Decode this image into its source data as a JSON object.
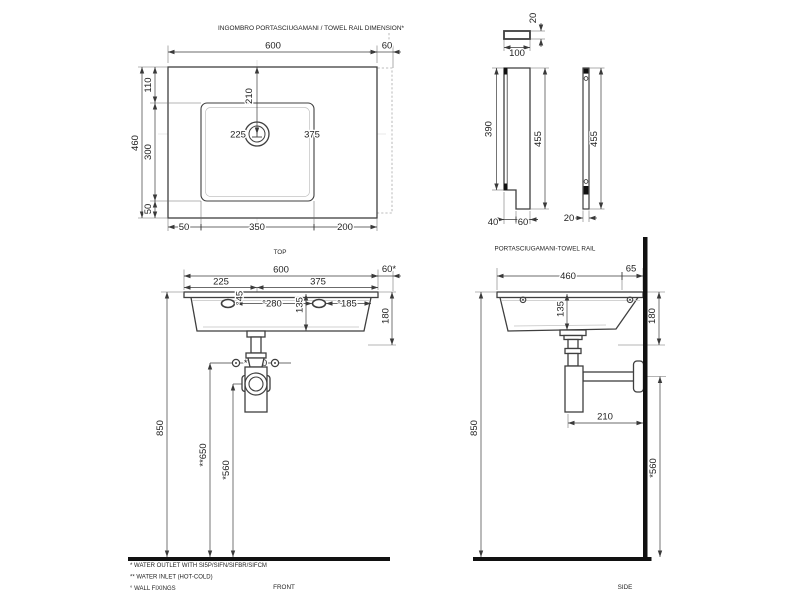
{
  "drawing": {
    "title": "INGOMBRO PORTASCIUGAMANI / TOWEL RAIL DIMENSION*",
    "views": {
      "top_label": "TOP",
      "front_label": "FRONT",
      "side_label": "SIDE",
      "rail_label": "PORTASCIUGAMANI-TOWEL RAIL"
    },
    "footnotes": {
      "outlet": "*  WATER OUTLET WITH SI5P/SIFN/SIFBR/SIFCM",
      "inlet": "** WATER INLET  (HOT-COLD)",
      "fixings": "° WALL FIXINGS"
    },
    "top": {
      "width": "600",
      "rail_overhang": "60",
      "edge_top": "110",
      "height": "460",
      "bowl_h": "300",
      "edge_bottom": "50",
      "drain_from_top": "210",
      "drain_left": "225",
      "drain_right": "375",
      "b_left": "50",
      "b_bowl": "350",
      "b_right": "200"
    },
    "front": {
      "width": "600",
      "rail": "60*",
      "left": "225",
      "right": "375",
      "hole_d": "°45",
      "holes_cc": "°280",
      "hole_edge": "°185",
      "depth_in": "135",
      "height_edge": "180",
      "inlet_cc": "**100",
      "floor": "850",
      "inlet_h": "**650",
      "outlet_h": "*560"
    },
    "side": {
      "depth": "460",
      "rail": "65",
      "depth_in": "135",
      "height_edge": "180",
      "outlet_wall": "210",
      "floor": "850",
      "outlet_h": "*560"
    },
    "rail": {
      "thickness_top": "20",
      "width": "100",
      "plate_h": "390",
      "total_h": "455",
      "hook_in": "40",
      "hook_out": "60",
      "bar_h": "455",
      "bar_w": "20"
    }
  }
}
